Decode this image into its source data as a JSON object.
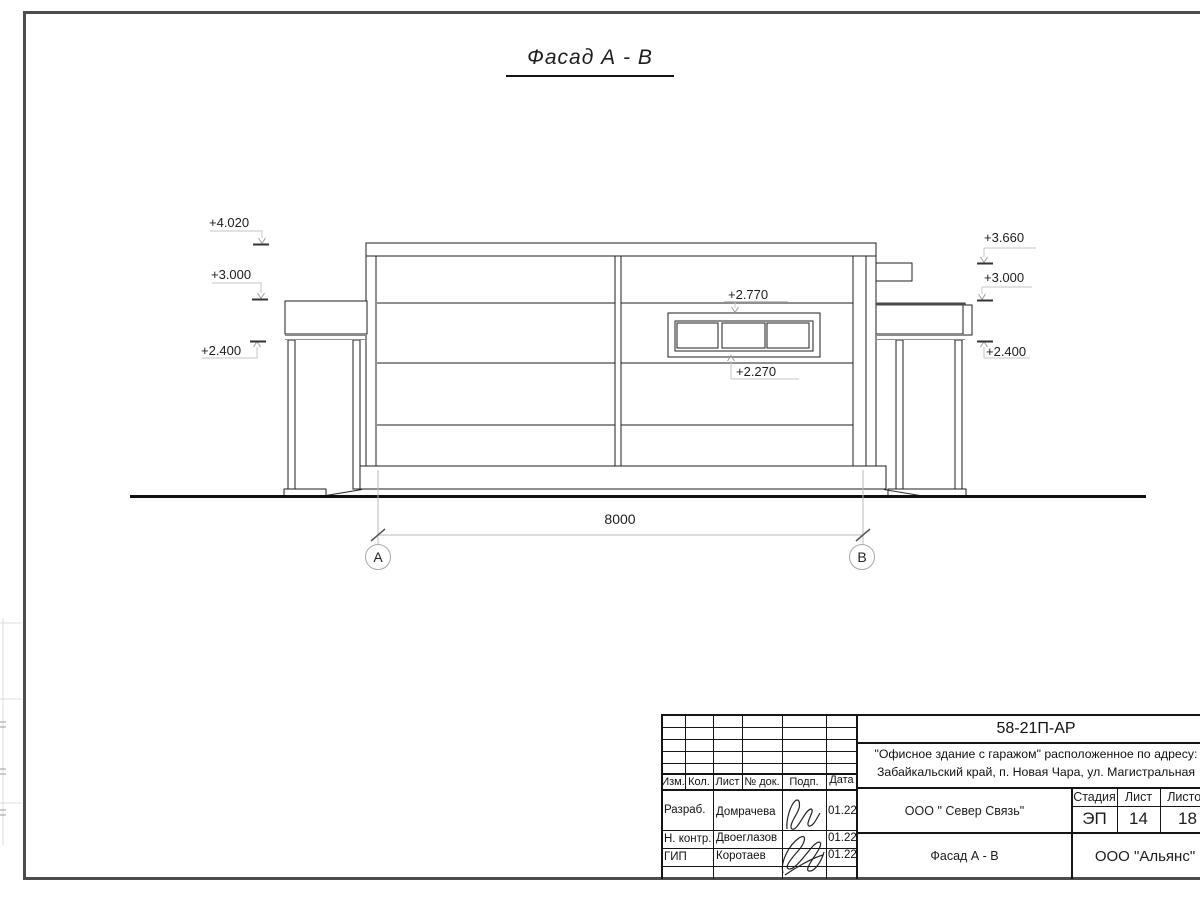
{
  "sheet": {
    "title": "Фасад А - В",
    "dimension_value": "8000",
    "axis_a": "А",
    "axis_b": "В"
  },
  "marks": {
    "left_top": "+4.020",
    "left_mid": "+3.000",
    "left_low": "+2.400",
    "right_top": "+3.660",
    "right_mid": "+3.000",
    "right_low": "+2.400",
    "window_top": "+2.770",
    "window_bottom": "+2.270"
  },
  "title_block": {
    "doc_number": "58-21П-АР",
    "project_line1": "\"Офисное здание с гаражом\" расположенное по адресу:",
    "project_line2": "Забайкальский край, п. Новая Чара, ул. Магистральная",
    "col_izm": "Изм.",
    "col_kol": "Кол.",
    "col_list": "Лист",
    "col_doc": "№ док.",
    "col_podp": "Подп.",
    "col_data": "Дата",
    "rows": [
      {
        "role": "Разраб.",
        "name": "Домрачева",
        "date": "01.22"
      },
      {
        "role": "Н. контр.",
        "name": "Двоеглазов",
        "date": "01.22"
      },
      {
        "role": "ГИП",
        "name": "Коротаев",
        "date": "01.22"
      }
    ],
    "org": "ООО \" Север Связь\"",
    "stage_label": "Стадия",
    "sheet_label": "Лист",
    "sheets_label": "Листов",
    "stage_value": "ЭП",
    "sheet_value": "14",
    "sheets_value": "18",
    "drawing_name": "Фасад А - В",
    "company": "ООО \"Альянс\""
  }
}
